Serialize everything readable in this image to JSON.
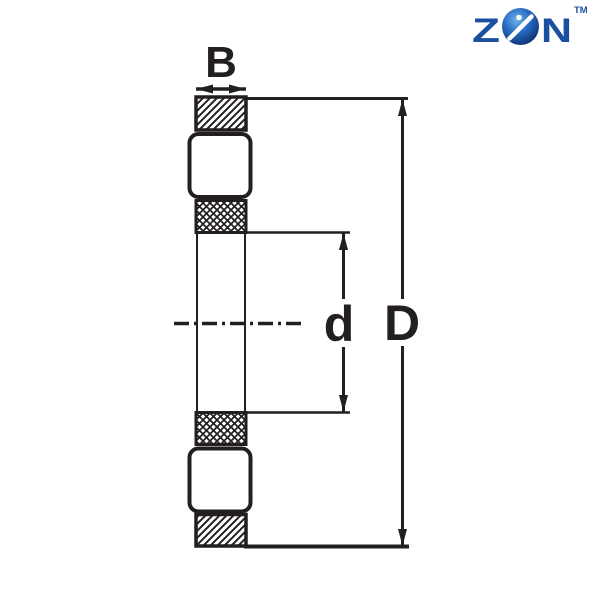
{
  "page": {
    "background": "#ffffff"
  },
  "logo": {
    "letter_z": "Z",
    "letter_n": "N",
    "trademark": "TM",
    "brand_color": "#1b4fa0",
    "sphere_edge": "#0b2d6b",
    "sphere_mid": "#2a6ec5",
    "sphere_highlight": "#6fb3e8",
    "slash_color": "#ffffff"
  },
  "diagram": {
    "ink_color": "#231f20",
    "labels": {
      "width_label": "B",
      "bore_label": "d",
      "outer_diameter_label": "D"
    }
  }
}
